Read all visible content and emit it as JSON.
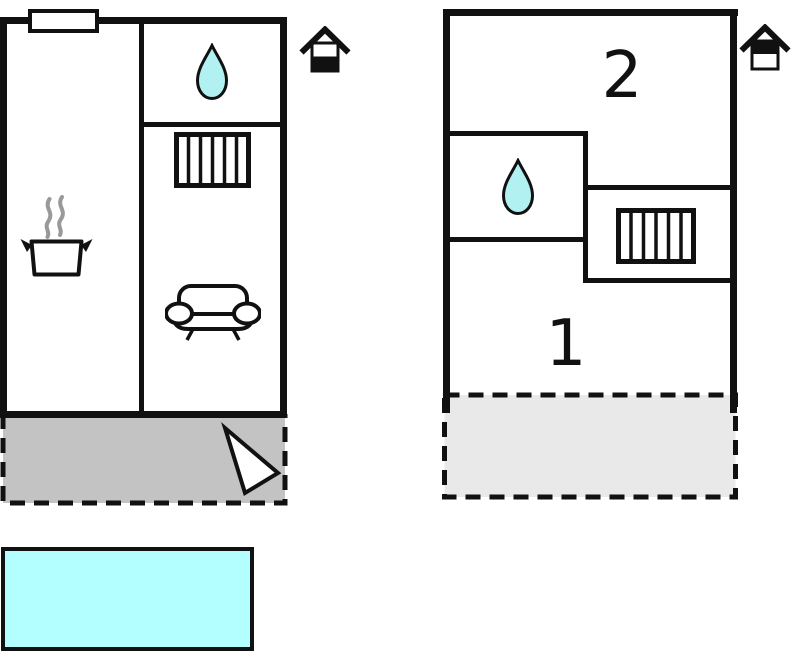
{
  "labels": {
    "upper_room_top": "2",
    "upper_room_bottom": "1"
  },
  "icons": {
    "ground_floor_indicator": "house-ground-floor-icon",
    "upper_floor_indicator": "house-upper-floor-icon",
    "bathroom": "water-drop-icon",
    "stairs": "stairs-icon",
    "kitchen": "cooking-pot-icon",
    "living_room": "sofa-icon",
    "terrace_arrow": "direction-arrow-icon",
    "pool": "swimming-pool"
  },
  "colors": {
    "outline": "#111111",
    "water_drop_fill": "#b2f1f1",
    "pool_fill": "#b3ffff",
    "ground_terrace_fill": "#c3c3c3",
    "upper_terrace_fill": "#e9e9e9",
    "steam": "#999999",
    "background": "#ffffff"
  }
}
